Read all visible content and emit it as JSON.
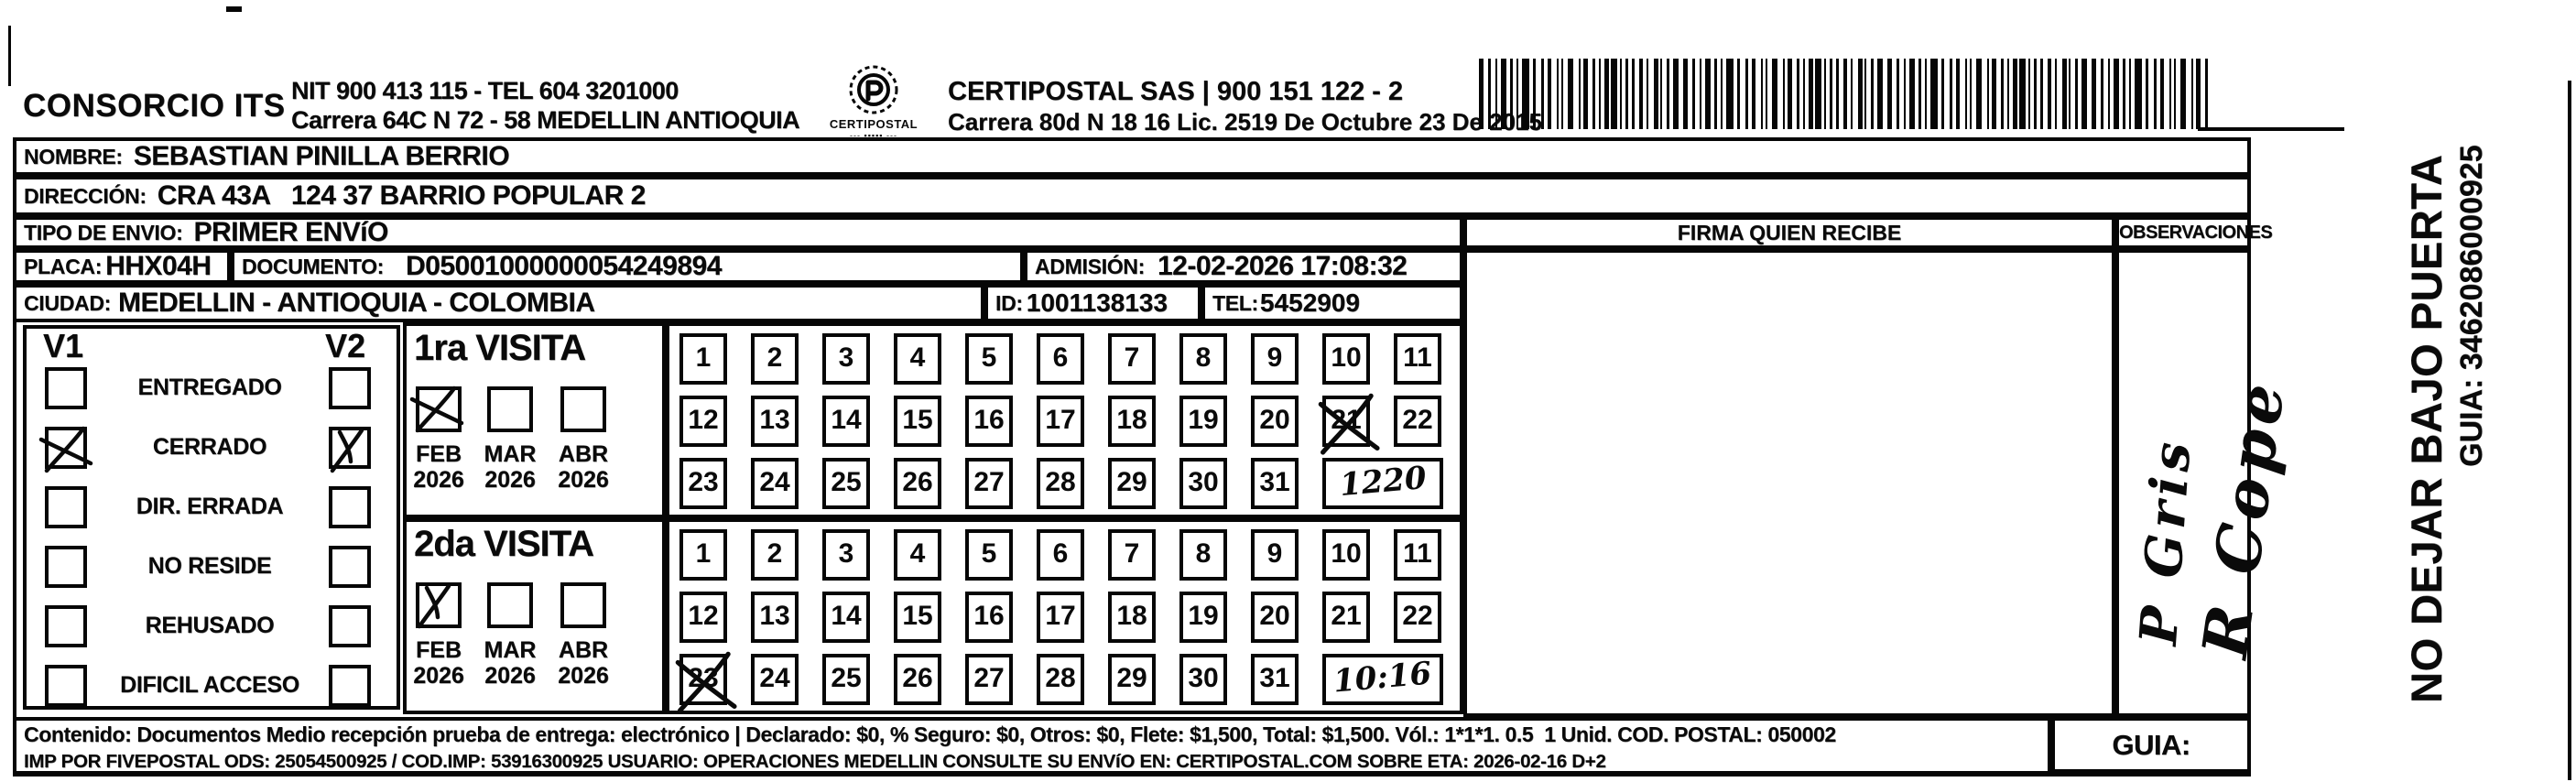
{
  "header": {
    "company_name": "CONSORCIO ITS",
    "nit_tel_line": "NIT 900 413 115 - TEL 604 3201000",
    "company_address": "Carrera 64C N 72 - 58 MEDELLIN ANTIOQUIA",
    "logo_caption": "CERTIPOSTAL",
    "partner_line": "CERTIPOSTAL SAS | 900 151 122 - 2",
    "partner_address": "Carrera 80d N 18 16  Lic. 2519 De Octubre 23 De 2015"
  },
  "shipment": {
    "nombre_label": "NOMBRE:",
    "nombre": "SEBASTIAN PINILLA BERRIO",
    "direccion_label": "DIRECCIÓN:",
    "direccion": "CRA 43A   124 37 BARRIO POPULAR 2",
    "tipo_envio_label": "TIPO DE ENVIO:",
    "tipo_envio": "PRIMER ENVíO",
    "placa_label": "PLACA:",
    "placa": "HHX04H",
    "documento_label": "DOCUMENTO:",
    "documento": "D05001000000054249894",
    "admision_label": "ADMISIÓN:",
    "admision": "12-02-2026 17:08:32",
    "ciudad_label": "CIUDAD:",
    "ciudad": "MEDELLIN - ANTIOQUIA - COLOMBIA",
    "id_label": "ID:",
    "id_value": "1001138133",
    "tel_label": "TEL:",
    "tel": "5452909"
  },
  "status_panel": {
    "col1_title": "V1",
    "col2_title": "V2",
    "rows": [
      {
        "label": "ENTREGADO",
        "v1_mark": "",
        "v2_mark": ""
      },
      {
        "label": "CERRADO",
        "v1_mark": "x",
        "v2_mark": "check"
      },
      {
        "label": "DIR. ERRADA",
        "v1_mark": "",
        "v2_mark": ""
      },
      {
        "label": "NO RESIDE",
        "v1_mark": "",
        "v2_mark": ""
      },
      {
        "label": "REHUSADO",
        "v1_mark": "",
        "v2_mark": ""
      },
      {
        "label": "DIFICIL ACCESO",
        "v1_mark": "",
        "v2_mark": ""
      }
    ]
  },
  "visits": [
    {
      "title": "1ra VISITA",
      "months": [
        {
          "month": "FEB",
          "year": "2026",
          "mark": "x"
        },
        {
          "month": "MAR",
          "year": "2026",
          "mark": ""
        },
        {
          "month": "ABR",
          "year": "2026",
          "mark": ""
        }
      ],
      "day_rows": [
        [
          1,
          2,
          3,
          4,
          5,
          6,
          7,
          8,
          9,
          10,
          11
        ],
        [
          12,
          13,
          14,
          15,
          16,
          17,
          18,
          19,
          20,
          21,
          22
        ],
        [
          23,
          24,
          25,
          26,
          27,
          28,
          29,
          30,
          31
        ]
      ],
      "crossed_days": [
        21
      ],
      "time_note": "1220"
    },
    {
      "title": "2da VISITA",
      "months": [
        {
          "month": "FEB",
          "year": "2026",
          "mark": "check"
        },
        {
          "month": "MAR",
          "year": "2026",
          "mark": ""
        },
        {
          "month": "ABR",
          "year": "2026",
          "mark": ""
        }
      ],
      "day_rows": [
        [
          1,
          2,
          3,
          4,
          5,
          6,
          7,
          8,
          9,
          10,
          11
        ],
        [
          12,
          13,
          14,
          15,
          16,
          17,
          18,
          19,
          20,
          21,
          22
        ],
        [
          23,
          24,
          25,
          26,
          27,
          28,
          29,
          30,
          31
        ]
      ],
      "crossed_days": [
        23
      ],
      "time_note": "10:16"
    }
  ],
  "signature_panel": {
    "firma_header": "FIRMA QUIEN RECIBE",
    "observaciones_header": "OBSERVACIONES",
    "handwritten_notes": [
      "P Gris",
      "R Cope"
    ]
  },
  "side_strip": {
    "warning": "NO DEJAR BAJO PUERTA",
    "guia": "GUIA: 3462086000925"
  },
  "footer": {
    "line1": "Contenido: Documentos Medio recepción prueba de entrega: electrónico | Declarado: $0, % Seguro: $0, Otros: $0, Flete: $1,500, Total: $1,500. Vól.: 1*1*1. 0.5  1 Unid. COD. POSTAL: 050002",
    "line2": "IMP POR FIVEPOSTAL ODS: 25054500925 / COD.IMP: 53916300925 USUARIO: OPERACIONES MEDELLIN CONSULTE SU ENVíO EN: CERTIPOSTAL.COM SOBRE ETA: 2026-02-16 D+2",
    "guia": "GUIA: 3462086000925"
  }
}
